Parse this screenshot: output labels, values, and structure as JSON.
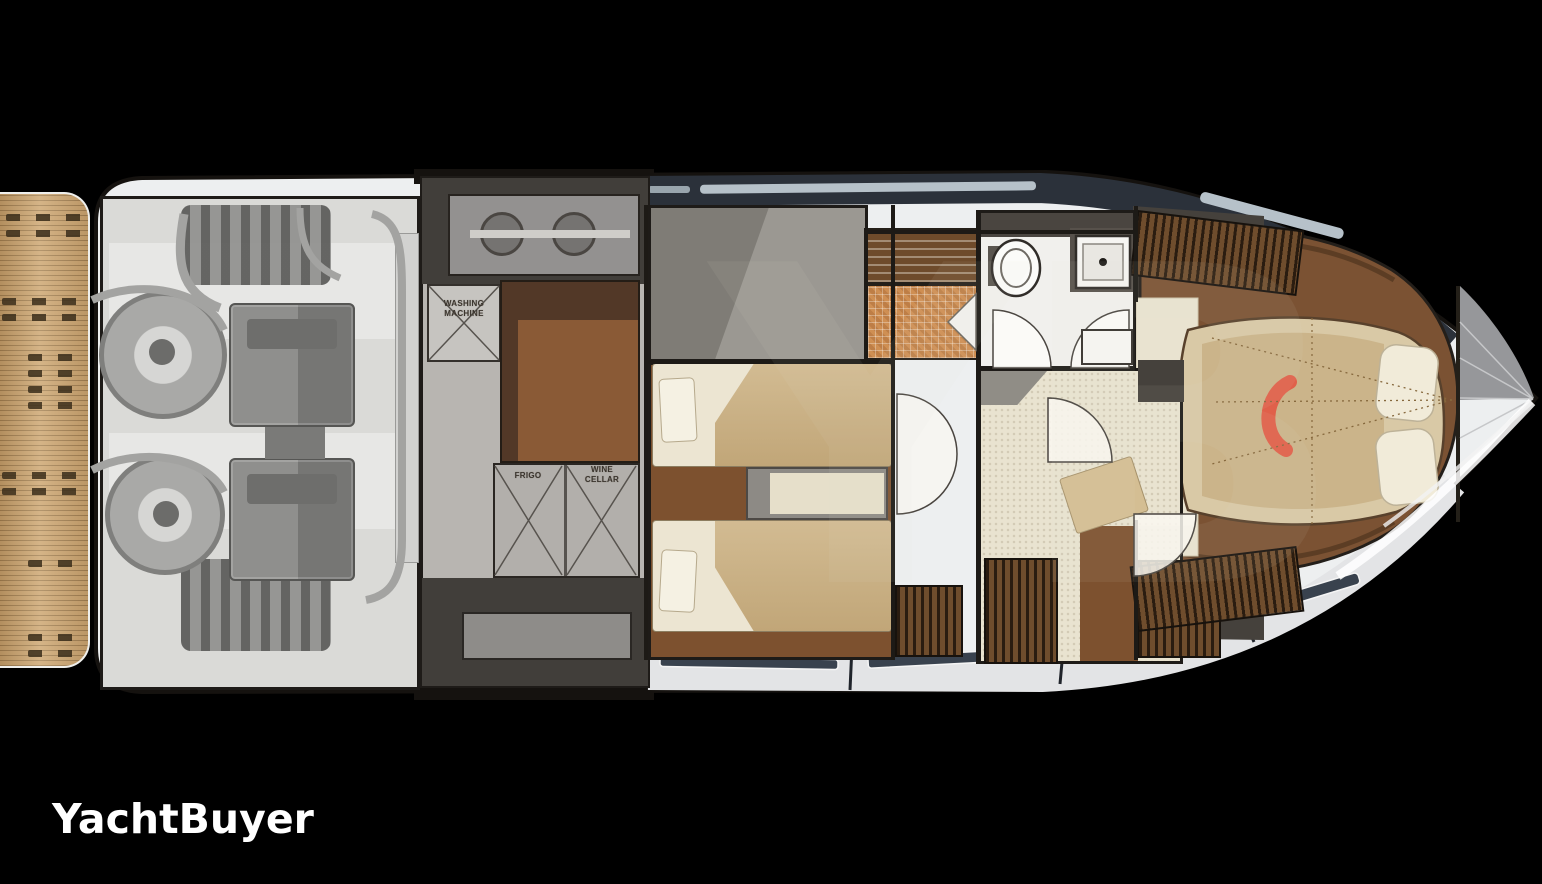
{
  "canvas": {
    "width": 1542,
    "height": 884,
    "background": "#000000"
  },
  "branding": {
    "logo_text": "YachtBuyer",
    "logo_color": "#ffffff",
    "watermark_text": "YB"
  },
  "floorplan": {
    "labels": {
      "washing_machine": [
        "WASHING",
        "MACHINE"
      ],
      "frigo": "FRIGO",
      "wine_cellar": [
        "WINE",
        "CELLAR"
      ]
    },
    "colors": {
      "hull": "#edeff0",
      "outline": "#15120f",
      "teak_platform": "#c7a271",
      "deck_band_dark": "#2b313a",
      "window_strip": "#b6c1c9",
      "engine_room_floor": "#dadad7",
      "engine_block": "#8f8f8d",
      "tech_dark": "#413e3a",
      "cabinet_dark_brown": "#523827",
      "cabinet_light_brown": "#8a5a36",
      "wood_floor": "#7d512f",
      "bed_sheet": "#ece5d2",
      "bed_blanket": "#c9ae83",
      "carpet": "#e9e3d0",
      "shower_tile": "#cf8f53",
      "master_wood": "#7b5233",
      "master_bed": "#d9c9a6",
      "pillow": "#f1ebd9",
      "accent_red": "#e0604a",
      "wardrobe_louver": "#6f4d2d"
    }
  }
}
